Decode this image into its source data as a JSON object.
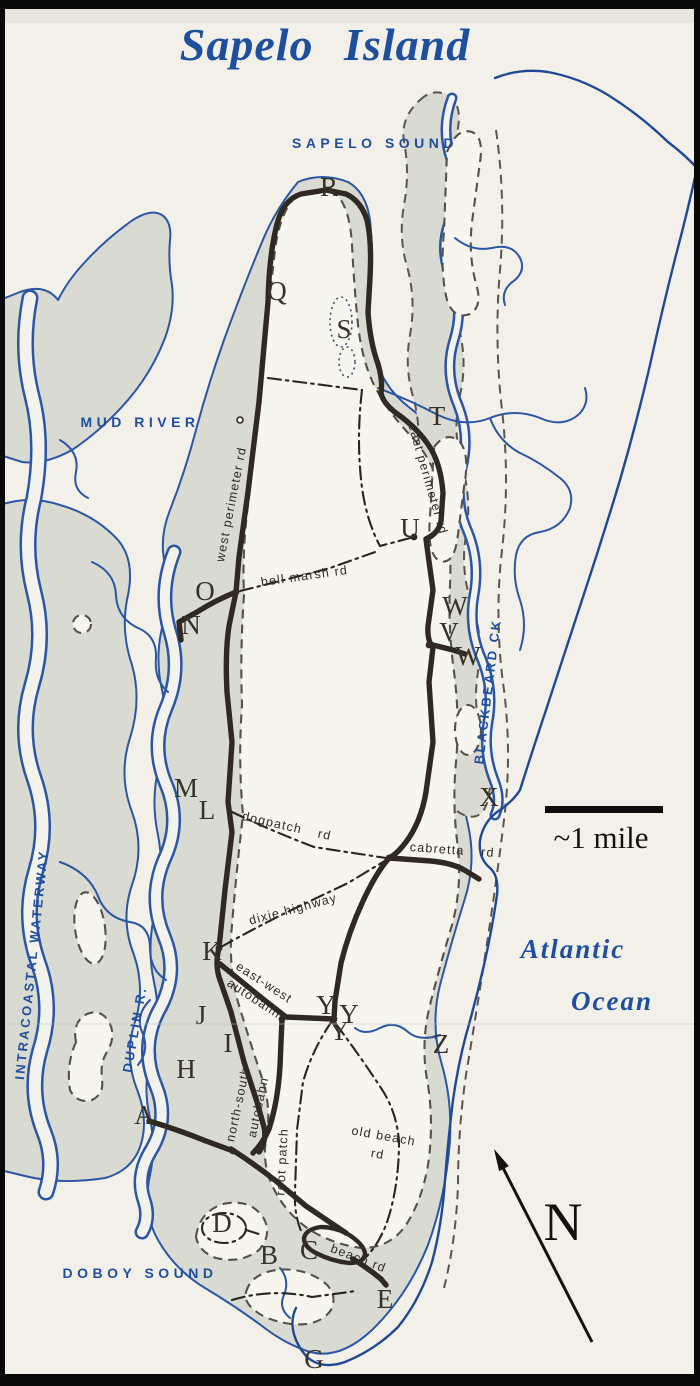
{
  "title": "Sapelo Island",
  "water_labels": {
    "sapelo_sound": "SAPELO SOUND",
    "mud_river": "MUD RIVER",
    "intracoastal_waterway": "INTRACOASTAL WATERWAY",
    "duplin_river": "DUPLIN R.",
    "blackbeard_creek": "BLACKBEARD CK",
    "atlantic_line1": "Atlantic",
    "atlantic_line2": "Ocean",
    "doboy_sound": "DOBOY SOUND"
  },
  "road_labels": {
    "west_perimeter": "west perimeter rd",
    "east_perimeter": "east perimeter rd",
    "bell_marsh": "bell marsh rd",
    "dogpatch": "dogpatch rd",
    "cabretta": "cabretta rd",
    "dixie_highway": "dixie highway",
    "east_west_line1": "east-west",
    "east_west_line2": "autobahn",
    "north_south_line1": "north-south",
    "north_south_line2": "autobahn",
    "root_patch": "root patch",
    "old_beach_line1": "old beach",
    "old_beach_line2": "rd",
    "beach": "beach rd"
  },
  "point_labels": {
    "r": "R",
    "q": "Q",
    "s": "S",
    "t": "T",
    "u": "U",
    "o": "O",
    "n": "N",
    "w1": "W",
    "v": "V",
    "w2": "W",
    "x": "X",
    "m": "M",
    "l": "L",
    "k": "K",
    "j": "J",
    "i": "I",
    "h": "H",
    "a": "A",
    "y1": "Y",
    "y2": "Y",
    "y3": "Y",
    "z": "Z",
    "d": "D",
    "b": "B",
    "c": "C",
    "e": "E",
    "g": "G"
  },
  "scale_bar": {
    "label": "~1 mile"
  },
  "compass": {
    "label": "N"
  },
  "colors": {
    "map_blue": "#1e4f9f",
    "shoreline_blue": "#2a56a4",
    "marsh_gray": "#d9dad1",
    "paper": "#f2f0e9",
    "road_black": "#2f2922"
  }
}
